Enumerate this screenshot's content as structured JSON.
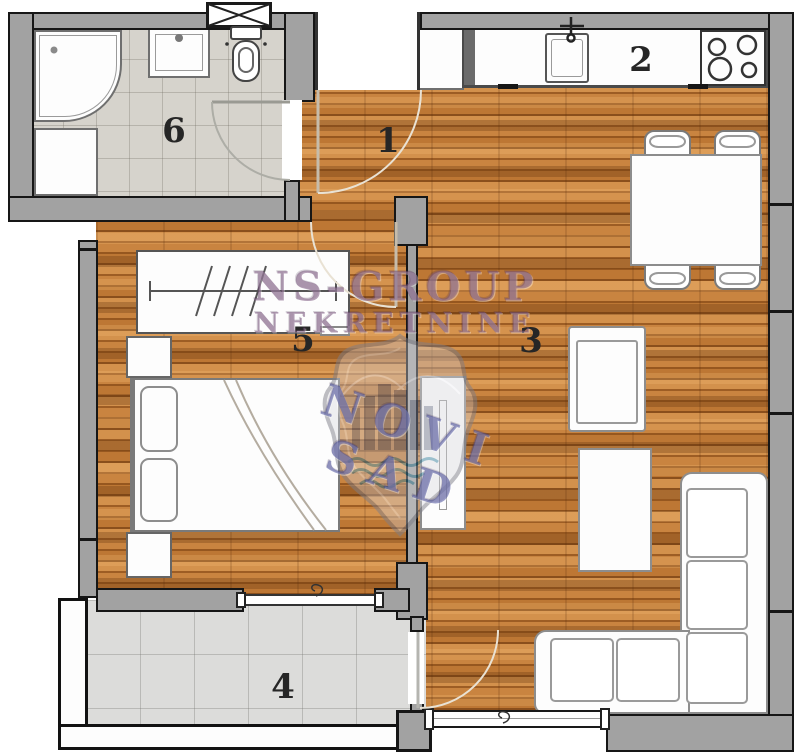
{
  "floorplan": {
    "watermark": {
      "line1": "NS–GROUP",
      "line2": "NEKRETNINE",
      "line3": "NOVI SAD"
    },
    "rooms": {
      "entry": {
        "label": "1"
      },
      "kitchen": {
        "label": "2"
      },
      "living": {
        "label": "3"
      },
      "terrace": {
        "label": "4"
      },
      "bedroom": {
        "label": "5"
      },
      "bathroom": {
        "label": "6"
      }
    },
    "colors": {
      "wood": "#b97433",
      "bath_tile": "#d6d3cc",
      "terrace_tile": "#dcdcda",
      "wall_gray": "#a2a2a2",
      "outline": "#161616",
      "watermark_purple": "#7a557d",
      "watermark_blue": "#4b509b"
    }
  }
}
